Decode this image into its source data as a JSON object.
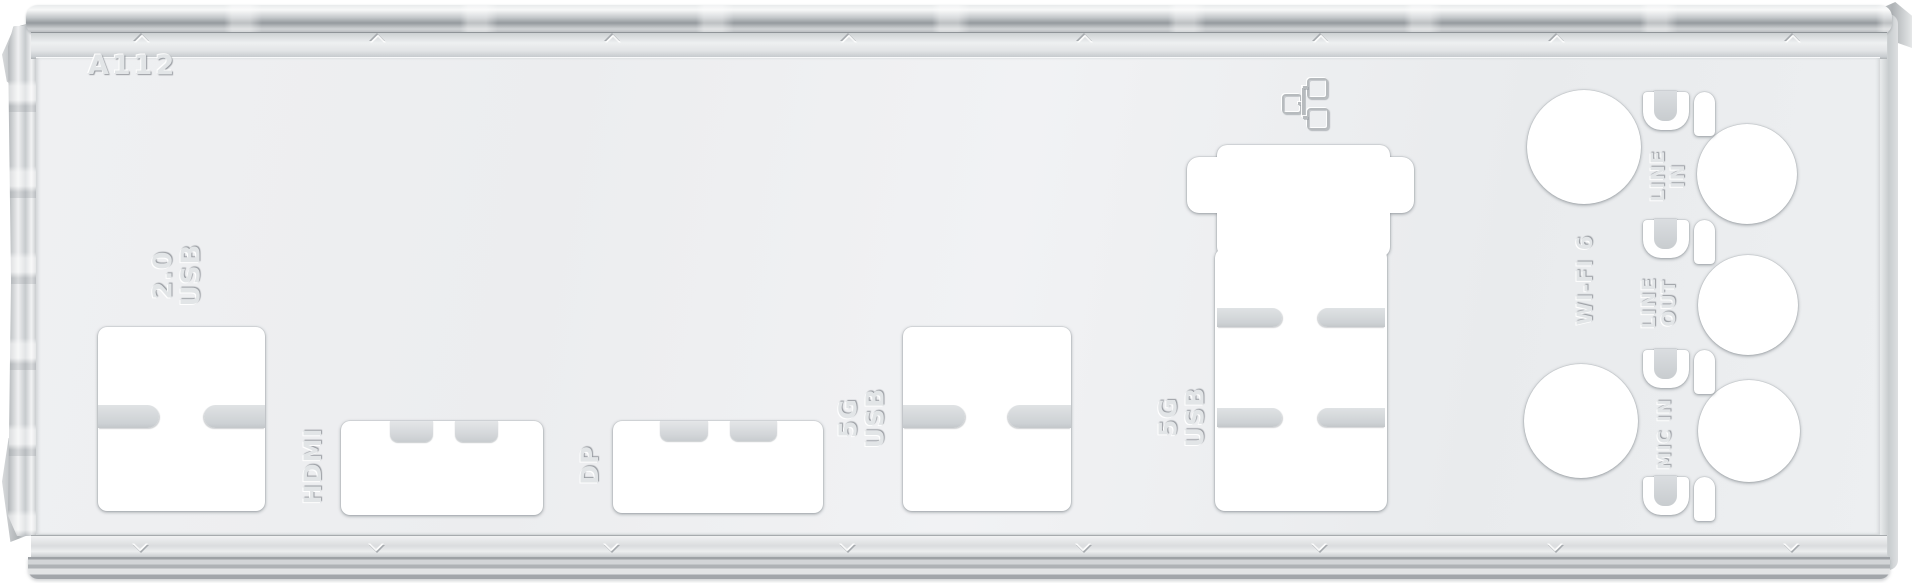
{
  "shield": {
    "stamp": "A112",
    "ports": {
      "usb20": {
        "label_lines": [
          "2.0",
          "USB"
        ]
      },
      "hdmi": {
        "label": "HDMI"
      },
      "dp": {
        "label": "DP"
      },
      "usb5g_left": {
        "label_lines": [
          "5G",
          "USB"
        ]
      },
      "usb5g_right": {
        "label_lines": [
          "5G",
          "USB"
        ]
      },
      "wifi": {
        "label": "WI-FI 6"
      },
      "line_in": {
        "label_lines": [
          "LINE",
          "IN"
        ]
      },
      "line_out": {
        "label_lines": [
          "LINE",
          "OUT"
        ]
      },
      "mic_in": {
        "label": "MIC IN"
      }
    },
    "icons": {
      "lan": "lan-network-icon"
    },
    "colors": {
      "plate_face": "#edeff1",
      "metal_dark": "#9aa0a4",
      "cutout": "#ffffff",
      "bent_tab": "#d2d6d9"
    }
  }
}
